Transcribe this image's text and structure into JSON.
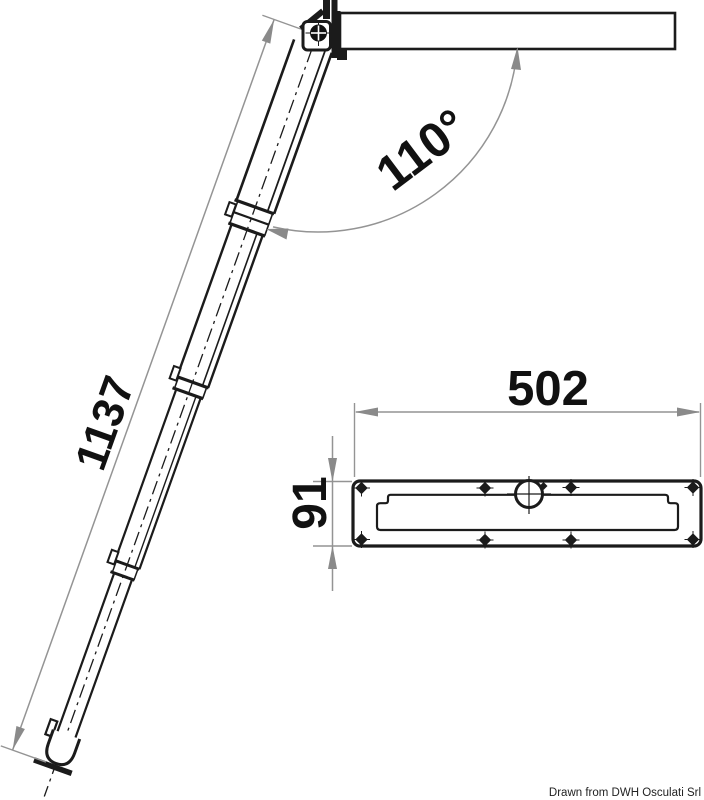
{
  "drawing": {
    "title": "telescopic-ladder-technical-drawing",
    "labels": {
      "ladder_length": "1137",
      "opening_angle": "110°",
      "plate_width": "502",
      "plate_depth": "91"
    },
    "credit": "Drawn from DWH Osculati Srl",
    "colors": {
      "line": "#1b1b1b",
      "dimension": "#949494",
      "background": "#ffffff"
    }
  }
}
